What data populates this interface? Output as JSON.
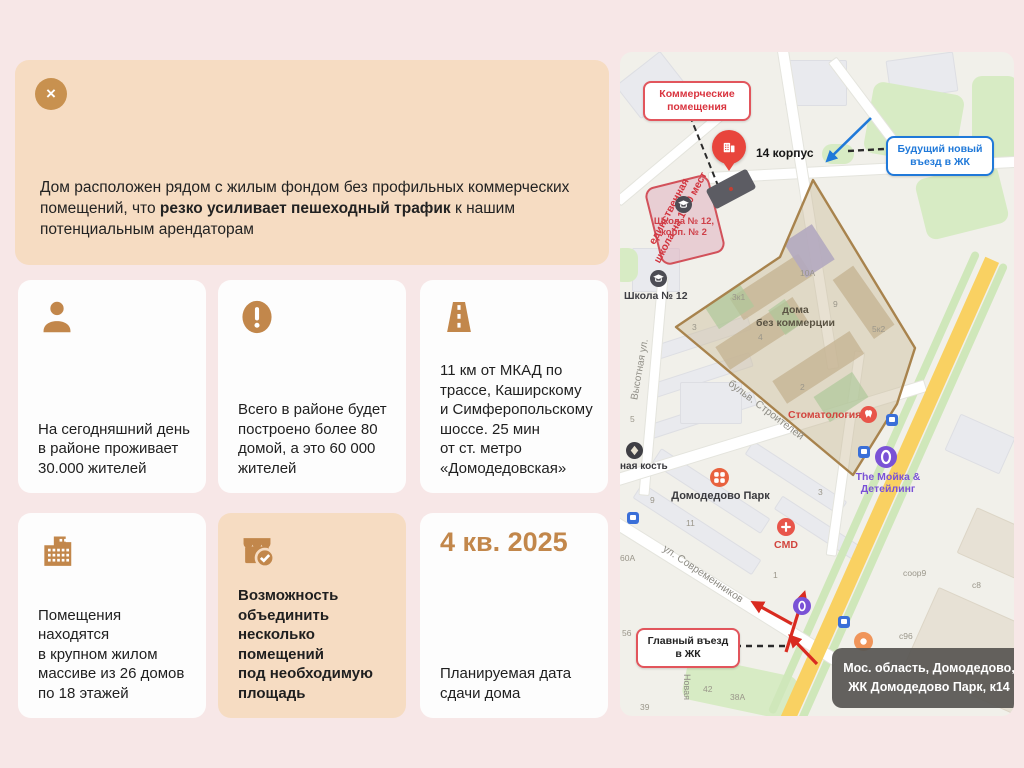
{
  "banner": {
    "close_icon": "×",
    "text_before": "Дом расположен рядом с жилым фондом без профильных коммерческих помещений, что ",
    "text_bold": "резко усиливает пешеходный трафик",
    "text_after": " к нашим потенциальным арендаторам"
  },
  "cards": [
    {
      "icon": "person-icon",
      "text": "На сегодняшний день\nв районе проживает\n30.000 жителей"
    },
    {
      "icon": "alert-icon",
      "text": "Всего в районе будет\nпостроено более 80\nдомой, а это 60 000\nжителей"
    },
    {
      "icon": "road-icon",
      "text": "11 км от МКАД по\nтрассе, Каширскому\nи Симферопольскому\nшоссе. 25 мин\nот ст. метро\n«Домодедовская»"
    },
    {
      "icon": "building-icon",
      "text": "Помещения находятся\nв крупном жилом\nмассиве из 26 домов\nпо 18 этажей"
    },
    {
      "icon": "store-check-icon",
      "text": "Возможность\nобъединить несколько\nпомещений\nпод необходимую\nплощадь"
    },
    {
      "icon": "none",
      "value": "4 кв. 2025",
      "text": "Планируемая дата\nсдачи дома"
    }
  ],
  "map": {
    "callout_commercial": "Коммерческие\nпомещения",
    "pin_label": "14 корпус",
    "callout_future": "Будущий новый\nвъезд в ЖК",
    "callout_main": "Главный въезд\nв ЖК",
    "note_school": "единственная\nшкола на 1500 мест",
    "school_12_2": "Школа № 12,\nкорп. № 2",
    "school_12": "Школа № 12",
    "zone": "дома\nбез коммерции",
    "poi_stomatology": "Стоматология",
    "poi_park": "Домодедово Парк",
    "poi_cmd": "CMD",
    "poi_moyka": "The Мойка &\nДетейлинг",
    "poi_kost": "ная кость",
    "street_1": "Высотная ул.",
    "street_2": "бульв. Строителей",
    "street_3": "ул. Современников",
    "street_4": "Новая",
    "address": "Мос. область, Домодедово,\nЖК Домодедово Парк, к14",
    "numbers": [
      "3к1",
      "3",
      "9",
      "5к2",
      "10А",
      "4",
      "2",
      "3",
      "1",
      "9",
      "11",
      "5",
      "60А",
      "56",
      "42",
      "38А",
      "39",
      "соор9",
      "с8",
      "с96"
    ]
  },
  "colors": {
    "accent_tan": "#c2874b",
    "highlight_bg": "#f6dcc2",
    "slide_bg": "#f7e7e7",
    "map_red": "#e8453c",
    "map_blue": "#2079d9",
    "map_purple": "#7a52d6",
    "zone_fill": "#c6a776",
    "zone_stroke": "#a8834d"
  }
}
